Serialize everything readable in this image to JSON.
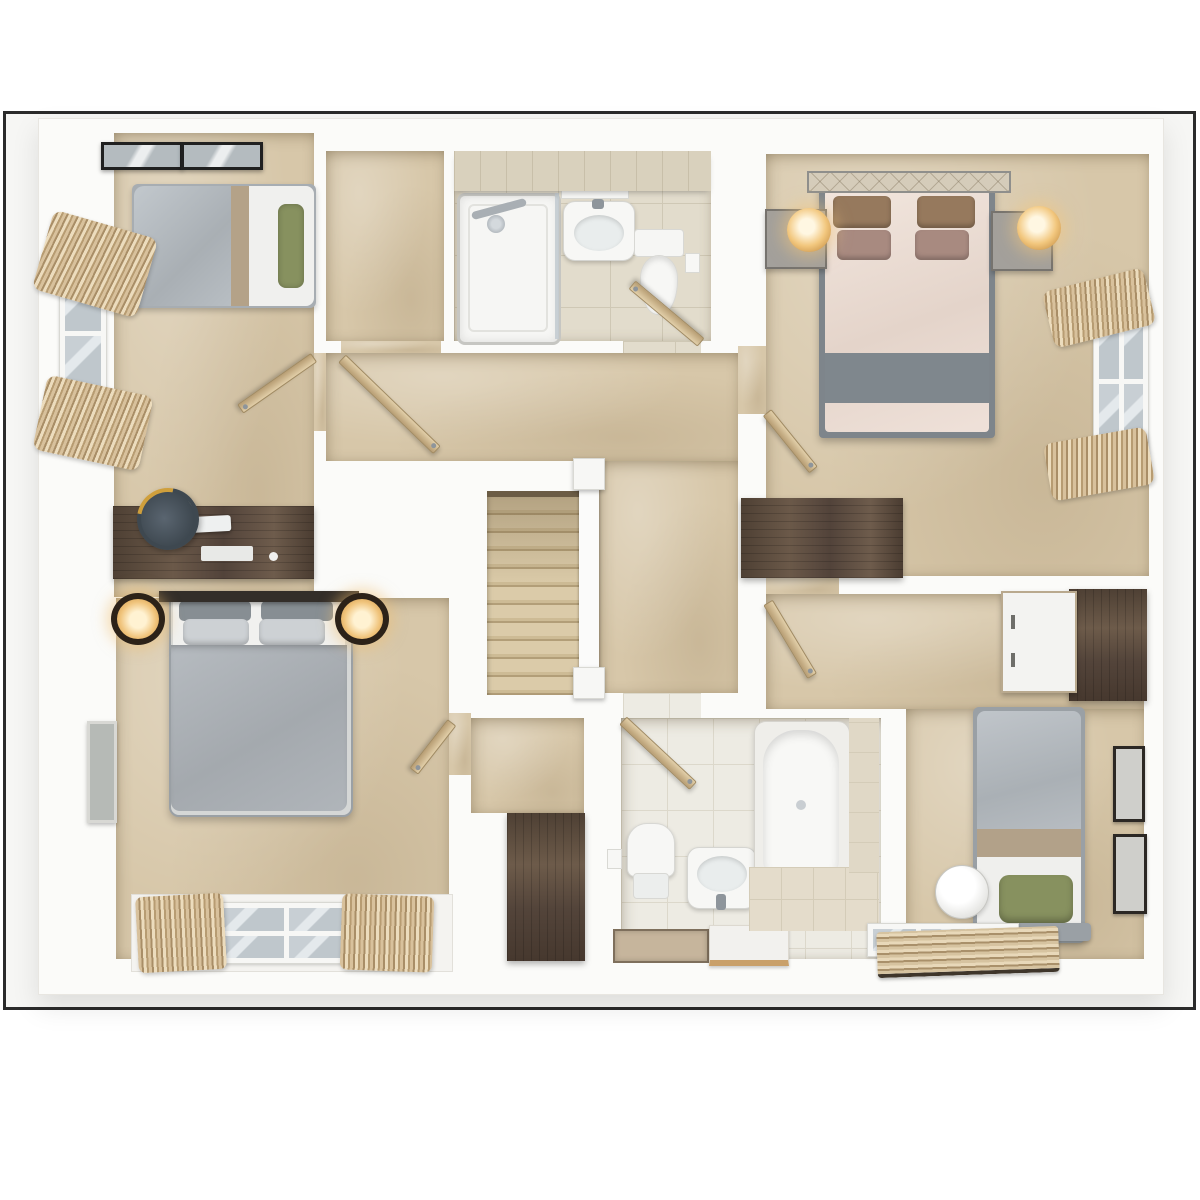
{
  "scene": {
    "type": "3d-floor-plan-render",
    "view": "top-down dollhouse cutaway",
    "level": "upper floor",
    "style": "photoreal render, white walls, beige carpet",
    "text_visible": "none"
  },
  "palette": {
    "frame_border": "#2b2b2b",
    "matte_bg": "#f6f6f4",
    "wall_white": "#fbfbf9",
    "carpet": "#d7c7a9",
    "tile_shower": "#e2dccc",
    "tile_bath": "#edebe3",
    "grout": "#cfc8b5",
    "wood_door": "#c9ae83",
    "walnut": "#5a4a3c",
    "duvet_gray": "#aeb3b8",
    "duvet_blush": "#ecdfd7",
    "blanket_gray": "#7f878d",
    "pillow_green": "#87915f",
    "pillow_brown": "#96795d",
    "pillow_mauve": "#a88a80",
    "textile_tan": "#b79c72",
    "lamp_glow": "#f2c77e",
    "chrome": "#8e959b",
    "glass": "#c8cfd4",
    "headboard_dark": "#332e29"
  },
  "rooms": {
    "bedroom_3": {
      "label": "Bedroom 3 (top left)",
      "floor": "carpet",
      "contents": [
        "single bed with gray duvet and green bolster",
        "two roof windows",
        "side window with roman blinds",
        "desk with monitor, keyboard and mouse",
        "desk chair",
        "door"
      ]
    },
    "top_closet": {
      "label": "Walk-in cupboard (top middle)",
      "floor": "carpet",
      "contents": [
        "door"
      ]
    },
    "shower_room": {
      "label": "En-suite shower room",
      "floor": "tile",
      "contents": [
        "shower enclosure with glass screen",
        "washbasin with mirror cabinet",
        "toilet",
        "toilet-roll holder",
        "door"
      ]
    },
    "master_bedroom": {
      "label": "Master bedroom (top right)",
      "floor": "carpet",
      "contents": [
        "double bed with blush duvet and gray runner",
        "lattice headboard",
        "two nightstands with glowing gold lamps",
        "low dresser",
        "window with roman blinds",
        "door"
      ]
    },
    "landing": {
      "label": "Landing and staircase",
      "floor": "carpet",
      "contents": [
        "carpeted staircase",
        "white balustrade with newel posts"
      ]
    },
    "bedroom_1": {
      "label": "Bedroom 1 (bottom left)",
      "floor": "carpet",
      "contents": [
        "double bed with gray duvet",
        "dark headboard shelf",
        "two bronze wall lamps",
        "wall mirror",
        "bay window with curtains",
        "door"
      ]
    },
    "storage_cupboard": {
      "label": "Storage cupboard by stairs",
      "floor": "carpet",
      "contents": [
        "tall walnut wardrobe"
      ]
    },
    "family_bathroom": {
      "label": "Family bathroom (bottom middle)",
      "floor": "tile",
      "contents": [
        "bathtub with chrome taps",
        "pedestal washbasin",
        "toilet",
        "toilet-roll holder",
        "two bath mats",
        "tiled tub surround",
        "door"
      ]
    },
    "bedroom_2": {
      "label": "Bedroom 2 (bottom right)",
      "floor": "carpet",
      "contents": [
        "single bed with gray duvet and green pillow",
        "round white lamp",
        "desk with walnut wardrobe",
        "two framed pictures",
        "window with drawn curtain",
        "door"
      ]
    }
  }
}
